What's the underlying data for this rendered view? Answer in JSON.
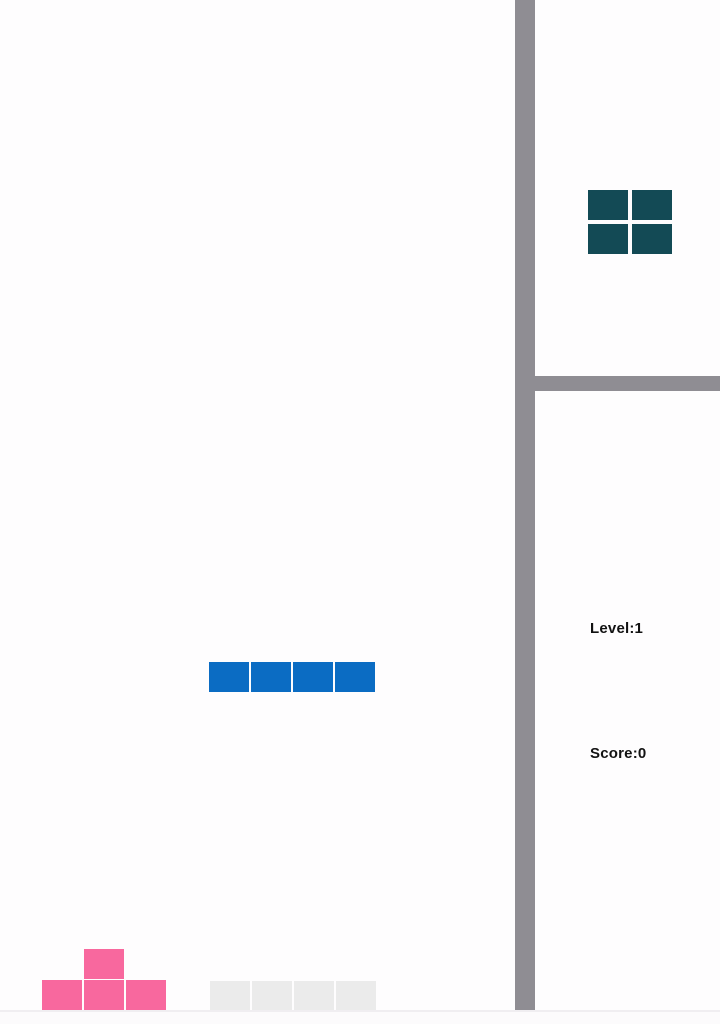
{
  "colors": {
    "active_piece": "#0b6cc3",
    "ghost_piece": "#ebebeb",
    "placed_piece": "#f8689e",
    "next_piece": "#134a55",
    "divider": "#8f8d93"
  },
  "game": {
    "level_text": "Level:1",
    "score_text": "Score:0",
    "level": 1,
    "score": 0
  },
  "board": {
    "pieces": [
      {
        "name": "active-piece-i",
        "type": "I",
        "role": "falling",
        "color_key": "active_piece",
        "cell_w": 40,
        "cell_h": 30,
        "cells": [
          [
            209,
            662
          ],
          [
            251,
            662
          ],
          [
            293,
            662
          ],
          [
            335,
            662
          ]
        ]
      },
      {
        "name": "ghost-piece-i",
        "type": "I",
        "role": "ghost",
        "color_key": "ghost_piece",
        "cell_w": 40,
        "cell_h": 29,
        "cells": [
          [
            210,
            981
          ],
          [
            252,
            981
          ],
          [
            294,
            981
          ],
          [
            336,
            981
          ]
        ]
      },
      {
        "name": "placed-piece-t",
        "type": "T",
        "role": "placed",
        "color_key": "placed_piece",
        "cell_w": 40,
        "cell_h": 30,
        "cells": [
          [
            84,
            949
          ],
          [
            42,
            980
          ],
          [
            84,
            980
          ],
          [
            126,
            980
          ]
        ]
      }
    ]
  },
  "sidebar": {
    "next_piece": {
      "name": "next-piece-o",
      "type": "O",
      "role": "preview",
      "color_key": "next_piece",
      "cell_w": 40,
      "cell_h": 30,
      "cells": [
        [
          588,
          190
        ],
        [
          632,
          190
        ],
        [
          588,
          224
        ],
        [
          632,
          224
        ]
      ]
    }
  }
}
